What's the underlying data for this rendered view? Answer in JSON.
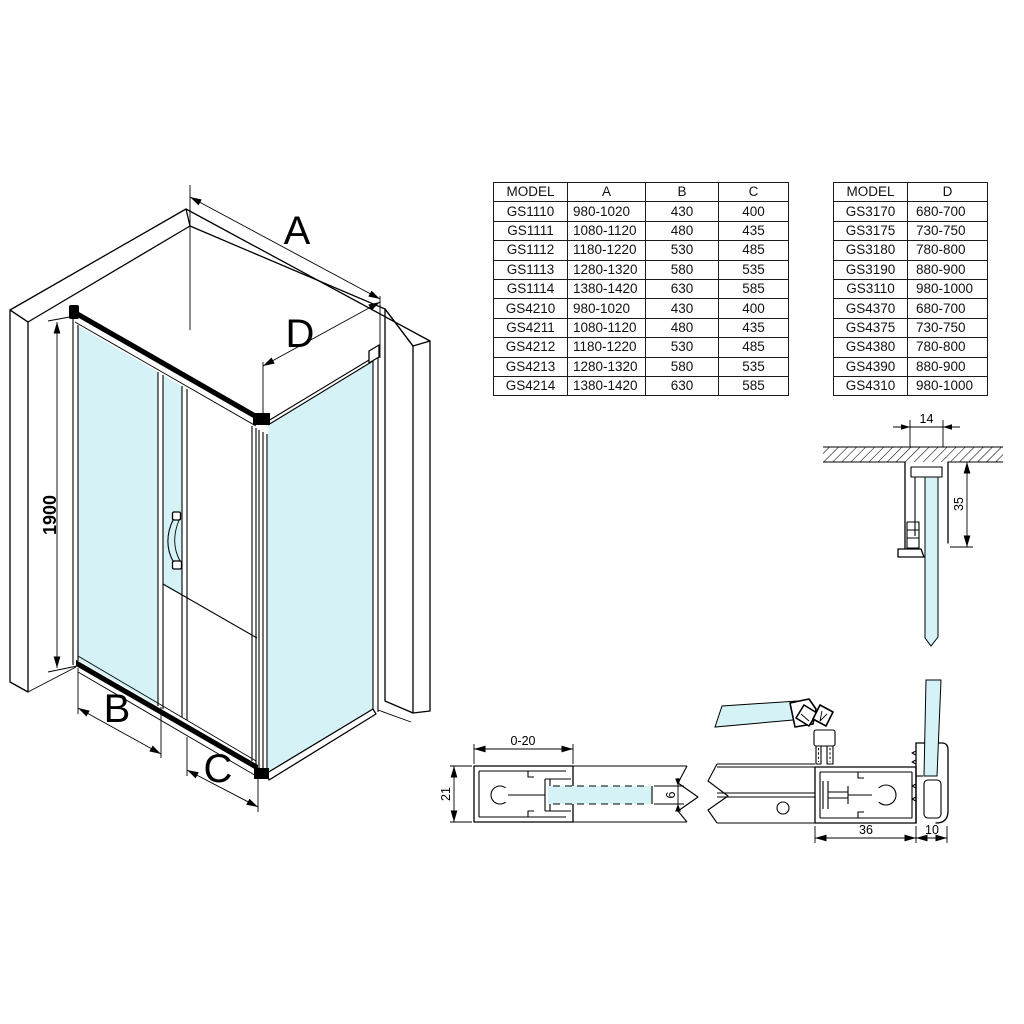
{
  "sheet": {
    "background": "#ffffff",
    "line_color": "#000000",
    "glass_color": "#d5f3f6"
  },
  "iso_view": {
    "dim_a": "A",
    "dim_d": "D",
    "dim_b": "B",
    "dim_c": "C",
    "dim_height": "1900"
  },
  "tables": {
    "main": {
      "columns": [
        "MODEL",
        "A",
        "B",
        "C"
      ],
      "rows": [
        [
          "GS1110",
          "980-1020",
          "430",
          "400"
        ],
        [
          "GS1111",
          "1080-1120",
          "480",
          "435"
        ],
        [
          "GS1112",
          "1180-1220",
          "530",
          "485"
        ],
        [
          "GS1113",
          "1280-1320",
          "580",
          "535"
        ],
        [
          "GS1114",
          "1380-1420",
          "630",
          "585"
        ],
        [
          "GS4210",
          "980-1020",
          "430",
          "400"
        ],
        [
          "GS4211",
          "1080-1120",
          "480",
          "435"
        ],
        [
          "GS4212",
          "1180-1220",
          "530",
          "485"
        ],
        [
          "GS4213",
          "1280-1320",
          "580",
          "535"
        ],
        [
          "GS4214",
          "1380-1420",
          "630",
          "585"
        ]
      ]
    },
    "side": {
      "columns": [
        "MODEL",
        "D"
      ],
      "rows": [
        [
          "GS3170",
          "680-700"
        ],
        [
          "GS3175",
          "730-750"
        ],
        [
          "GS3180",
          "780-800"
        ],
        [
          "GS3190",
          "880-900"
        ],
        [
          "GS3110",
          "980-1000"
        ],
        [
          "GS4370",
          "680-700"
        ],
        [
          "GS4375",
          "730-750"
        ],
        [
          "GS4380",
          "780-800"
        ],
        [
          "GS4390",
          "880-900"
        ],
        [
          "GS4310",
          "980-1000"
        ]
      ]
    }
  },
  "details": {
    "wall_profile": {
      "dim_width": "14",
      "dim_depth": "35"
    },
    "adjust_profile": {
      "dim_range": "0-20",
      "dim_height": "21",
      "dim_glass": "6"
    },
    "corner_profile": {
      "dim_rail": "36",
      "dim_cap": "10"
    }
  }
}
